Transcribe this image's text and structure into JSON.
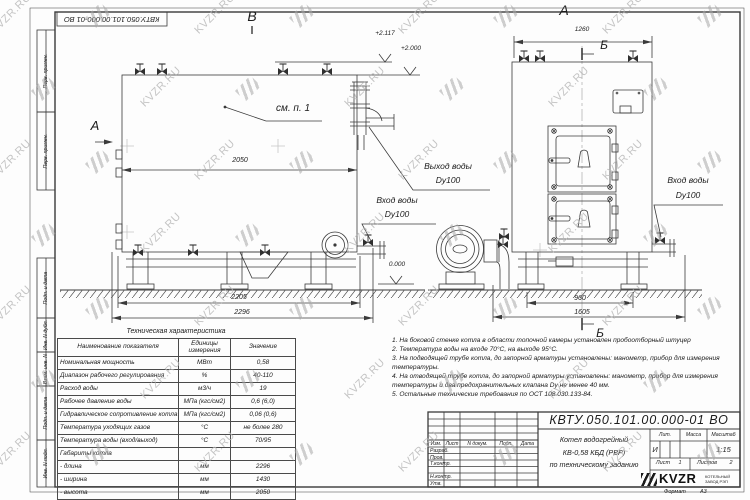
{
  "watermark": {
    "text": "KVZR.RU"
  },
  "frame": {
    "top_left_stamp": "КВТУ.050.101.00.000-01 ВО",
    "side_labels_top": [
      "Перв. примен.",
      "Перв. примен."
    ],
    "side_labels_bottom": [
      "Подп. и дата",
      "Инв. N дубл.",
      "Взам. инв. N",
      "Подп. и дата",
      "Инв. N подл."
    ]
  },
  "views": {
    "left": {
      "marker_top": "В",
      "section_label": "А",
      "callout": "см. п. 1",
      "elev_top": "+2.117",
      "elev_top2": "+2.000",
      "elev_zero": "0.000",
      "dim_width": "2050",
      "dim_base": "2205",
      "dim_overall": "2296"
    },
    "right": {
      "marker_top": "А",
      "section_marker_top": "Б",
      "section_marker_bottom": "Б",
      "dim_top": "1260",
      "dim_base": "960",
      "dim_overall": "1605"
    },
    "labels": {
      "outlet": "Выход воды",
      "outlet_dn": "Dy100",
      "inlet_left": "Вход воды",
      "inlet_left_dn": "Dy100",
      "inlet_right": "Вход воды",
      "inlet_right_dn": "Dy100"
    }
  },
  "spec_table": {
    "title": "Техническая характеристика",
    "headers": [
      "Наименование показателя",
      "Единицы измерения",
      "Значение"
    ],
    "rows": [
      [
        "Номинальная мощность",
        "МВт",
        "0,58"
      ],
      [
        "Диапазон рабочего регулирования",
        "%",
        "40-110"
      ],
      [
        "Расход воды",
        "м3/ч",
        "19"
      ],
      [
        "Рабочее давление воды",
        "МПа (кгс/см2)",
        "0,6 (6,0)"
      ],
      [
        "Гидравлическое сопротивление котла",
        "МПа (кгс/см2)",
        "0,06 (0,6)"
      ],
      [
        "Температура уходящих газов",
        "°С",
        "не более 280"
      ],
      [
        "Температура воды (вход/выход)",
        "°С",
        "70/95"
      ],
      [
        "Габариты котла",
        "",
        ""
      ],
      [
        "- длина",
        "мм",
        "2296"
      ],
      [
        "- ширина",
        "мм",
        "1430"
      ],
      [
        "- высота",
        "мм",
        "2050"
      ]
    ]
  },
  "notes": [
    "1. На боковой стенке котла в области топочной камеры установлен пробоотборный штуцер",
    "2. Температура воды на входе 70°С, на выходе 95°С.",
    "3. На подводящей трубе котла, до запорной арматуры установлены: манометр, прибор для измерения температуры.",
    "4. На отводящей трубе котла, до запорной арматуры установлены: манометр, прибор для измерения температуры и два предохранительных клапана Dy не менее 40 мм.",
    "5. Остальные технические требования по ОСТ 108.030.133-84."
  ],
  "title_block": {
    "doc_number": "КВТУ.050.101.00.000-01 ВО",
    "rev_headers": [
      "Изм.",
      "Лист",
      "N докум.",
      "Подп.",
      "Дата"
    ],
    "sign_rows": [
      "Разраб.",
      "Пров.",
      "Т.контр.",
      "",
      "Н.контр.",
      "Утв."
    ],
    "title_lines": [
      "Котел водогрейный",
      "КВ-0,58 КБД (РВР)",
      "по техническому заданию"
    ],
    "lit_headers": [
      "Лит.",
      "Масса",
      "Масштаб"
    ],
    "lit_value": "И",
    "scale": "1:15",
    "sheet_label": "Лист",
    "sheet_value": "1",
    "sheets_label": "Листов",
    "sheets_value": "2",
    "logo_text": "KVZR",
    "logo_sub1": "КОТЕЛЬНЫЙ",
    "logo_sub2": "ЗАВОД РЭП",
    "format_label": "Формат",
    "format_value": "А3"
  }
}
